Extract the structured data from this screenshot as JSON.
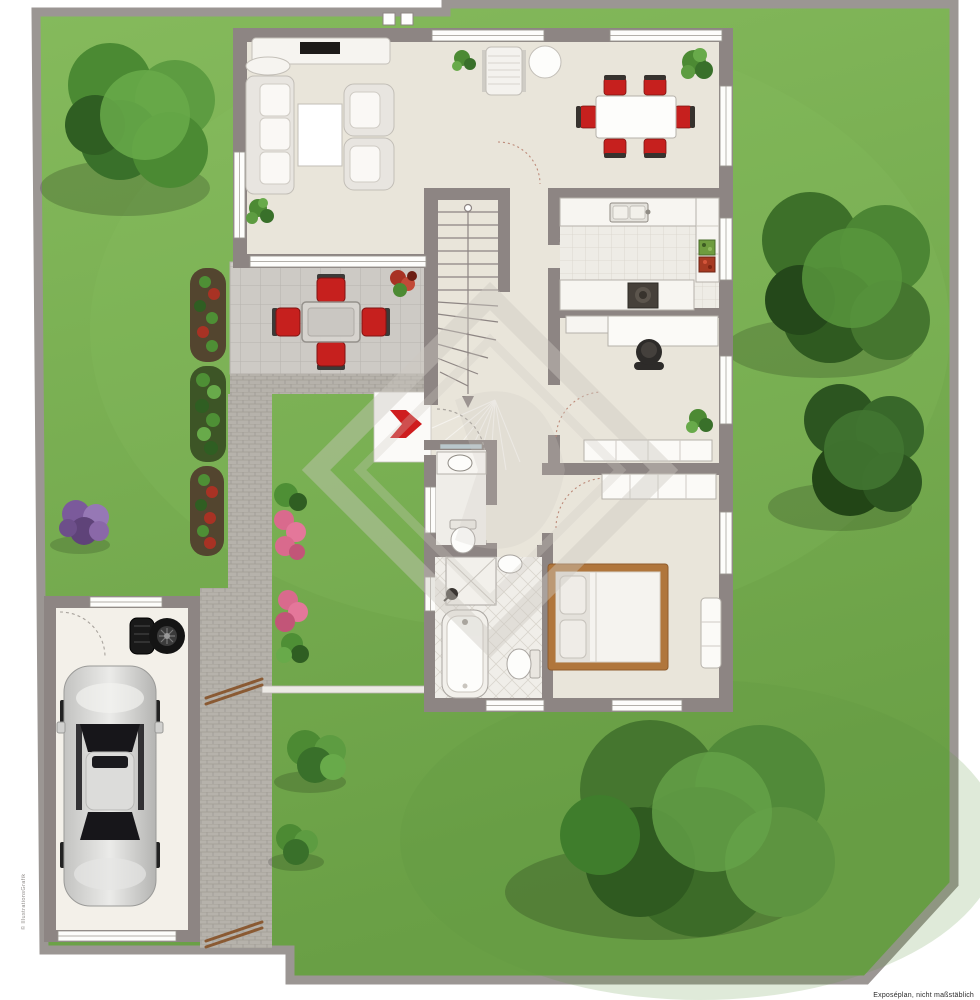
{
  "scene": {
    "type": "ground-floor plan of a house with garden plot, top view, real-estate exposé illustration",
    "footnote": "Exposéplan, nicht maßstäblich",
    "side_watermark": "© IllustrationsGrafik"
  },
  "palette": {
    "background": "#ffffff",
    "grass_light": "#85ba5c",
    "grass_dark": "#699f45",
    "boundary_wall": "#9b9693",
    "house_wall": "#8d8583",
    "floor": "#e9e5da",
    "kitchen_tile": "#eeece6",
    "bath_tile": "#f0eee9",
    "tile_line": "#d8d4cb",
    "terrace_tile": "#cdcac5",
    "terrace_line": "#b7b4af",
    "brick_path": "#b6b2ab",
    "brick_line": "#9f9b94",
    "furniture_white": "#f7f5f1",
    "furniture_stroke": "#b5b1aa",
    "chair_red": "#c6201e",
    "entrance_arrow_red": "#cf1d1f",
    "bed_wood": "#b0763c",
    "gate_wood": "#8a5a33",
    "car_silver": "#d8d8d6",
    "car_glass": "#17161a",
    "tree_green_main": "#4b8a33",
    "tree_green_dark": "#2f5a20",
    "tree_green_light": "#68aa4a",
    "bush_purple": "#7b5a9b",
    "flower_pink": "#d96a8d",
    "flower_red": "#a83224",
    "watermark_gray": "#cdc9c2"
  },
  "house": {
    "rooms": [
      {
        "name": "living-room",
        "furniture": [
          "sofa",
          "coffee-table",
          "armchair",
          "armchair",
          "tv-sideboard",
          "plant"
        ]
      },
      {
        "name": "dining-area",
        "furniture": [
          "dining-table",
          "six-red-chairs",
          "round-side-table",
          "chaise-lounge",
          "plant",
          "corner-plant"
        ]
      },
      {
        "name": "kitchen",
        "furniture": [
          "counter-with-sink",
          "tall-cabinet",
          "cooktop",
          "produce-crates",
          "tiled-floor"
        ]
      },
      {
        "name": "home-office",
        "furniture": [
          "desk",
          "office-chair",
          "cabinet",
          "sideboard",
          "plant"
        ]
      },
      {
        "name": "hallway",
        "features": [
          "u-shaped-winder-staircase",
          "front-door",
          "red-entrance-arrow",
          "porch"
        ]
      },
      {
        "name": "guest-wc",
        "furniture": [
          "washbasin-counter",
          "mirror",
          "toilet"
        ]
      },
      {
        "name": "bathroom",
        "furniture": [
          "shower",
          "washbasin",
          "bathtub",
          "toilet",
          "diamond-tiled-floor"
        ]
      },
      {
        "name": "bedroom",
        "furniture": [
          "wardrobe",
          "double-bed",
          "dresser"
        ]
      }
    ]
  },
  "garden": {
    "elements": [
      "lawn",
      "boundary-wall",
      "terrace-with-table-and-four-red-chairs",
      "brick-path",
      "flower-beds",
      "pink-flower-groups",
      "purple-bush",
      "round-bushes",
      "large-tree-top-left",
      "large-tree-right",
      "conifer-tree-right",
      "large-tree-bottom-right",
      "wooden-gates",
      "garden-fence"
    ],
    "garage": {
      "contents": [
        "silver-car-top-view",
        "tire-stack",
        "spare-wheel",
        "garage-door",
        "window"
      ]
    }
  }
}
